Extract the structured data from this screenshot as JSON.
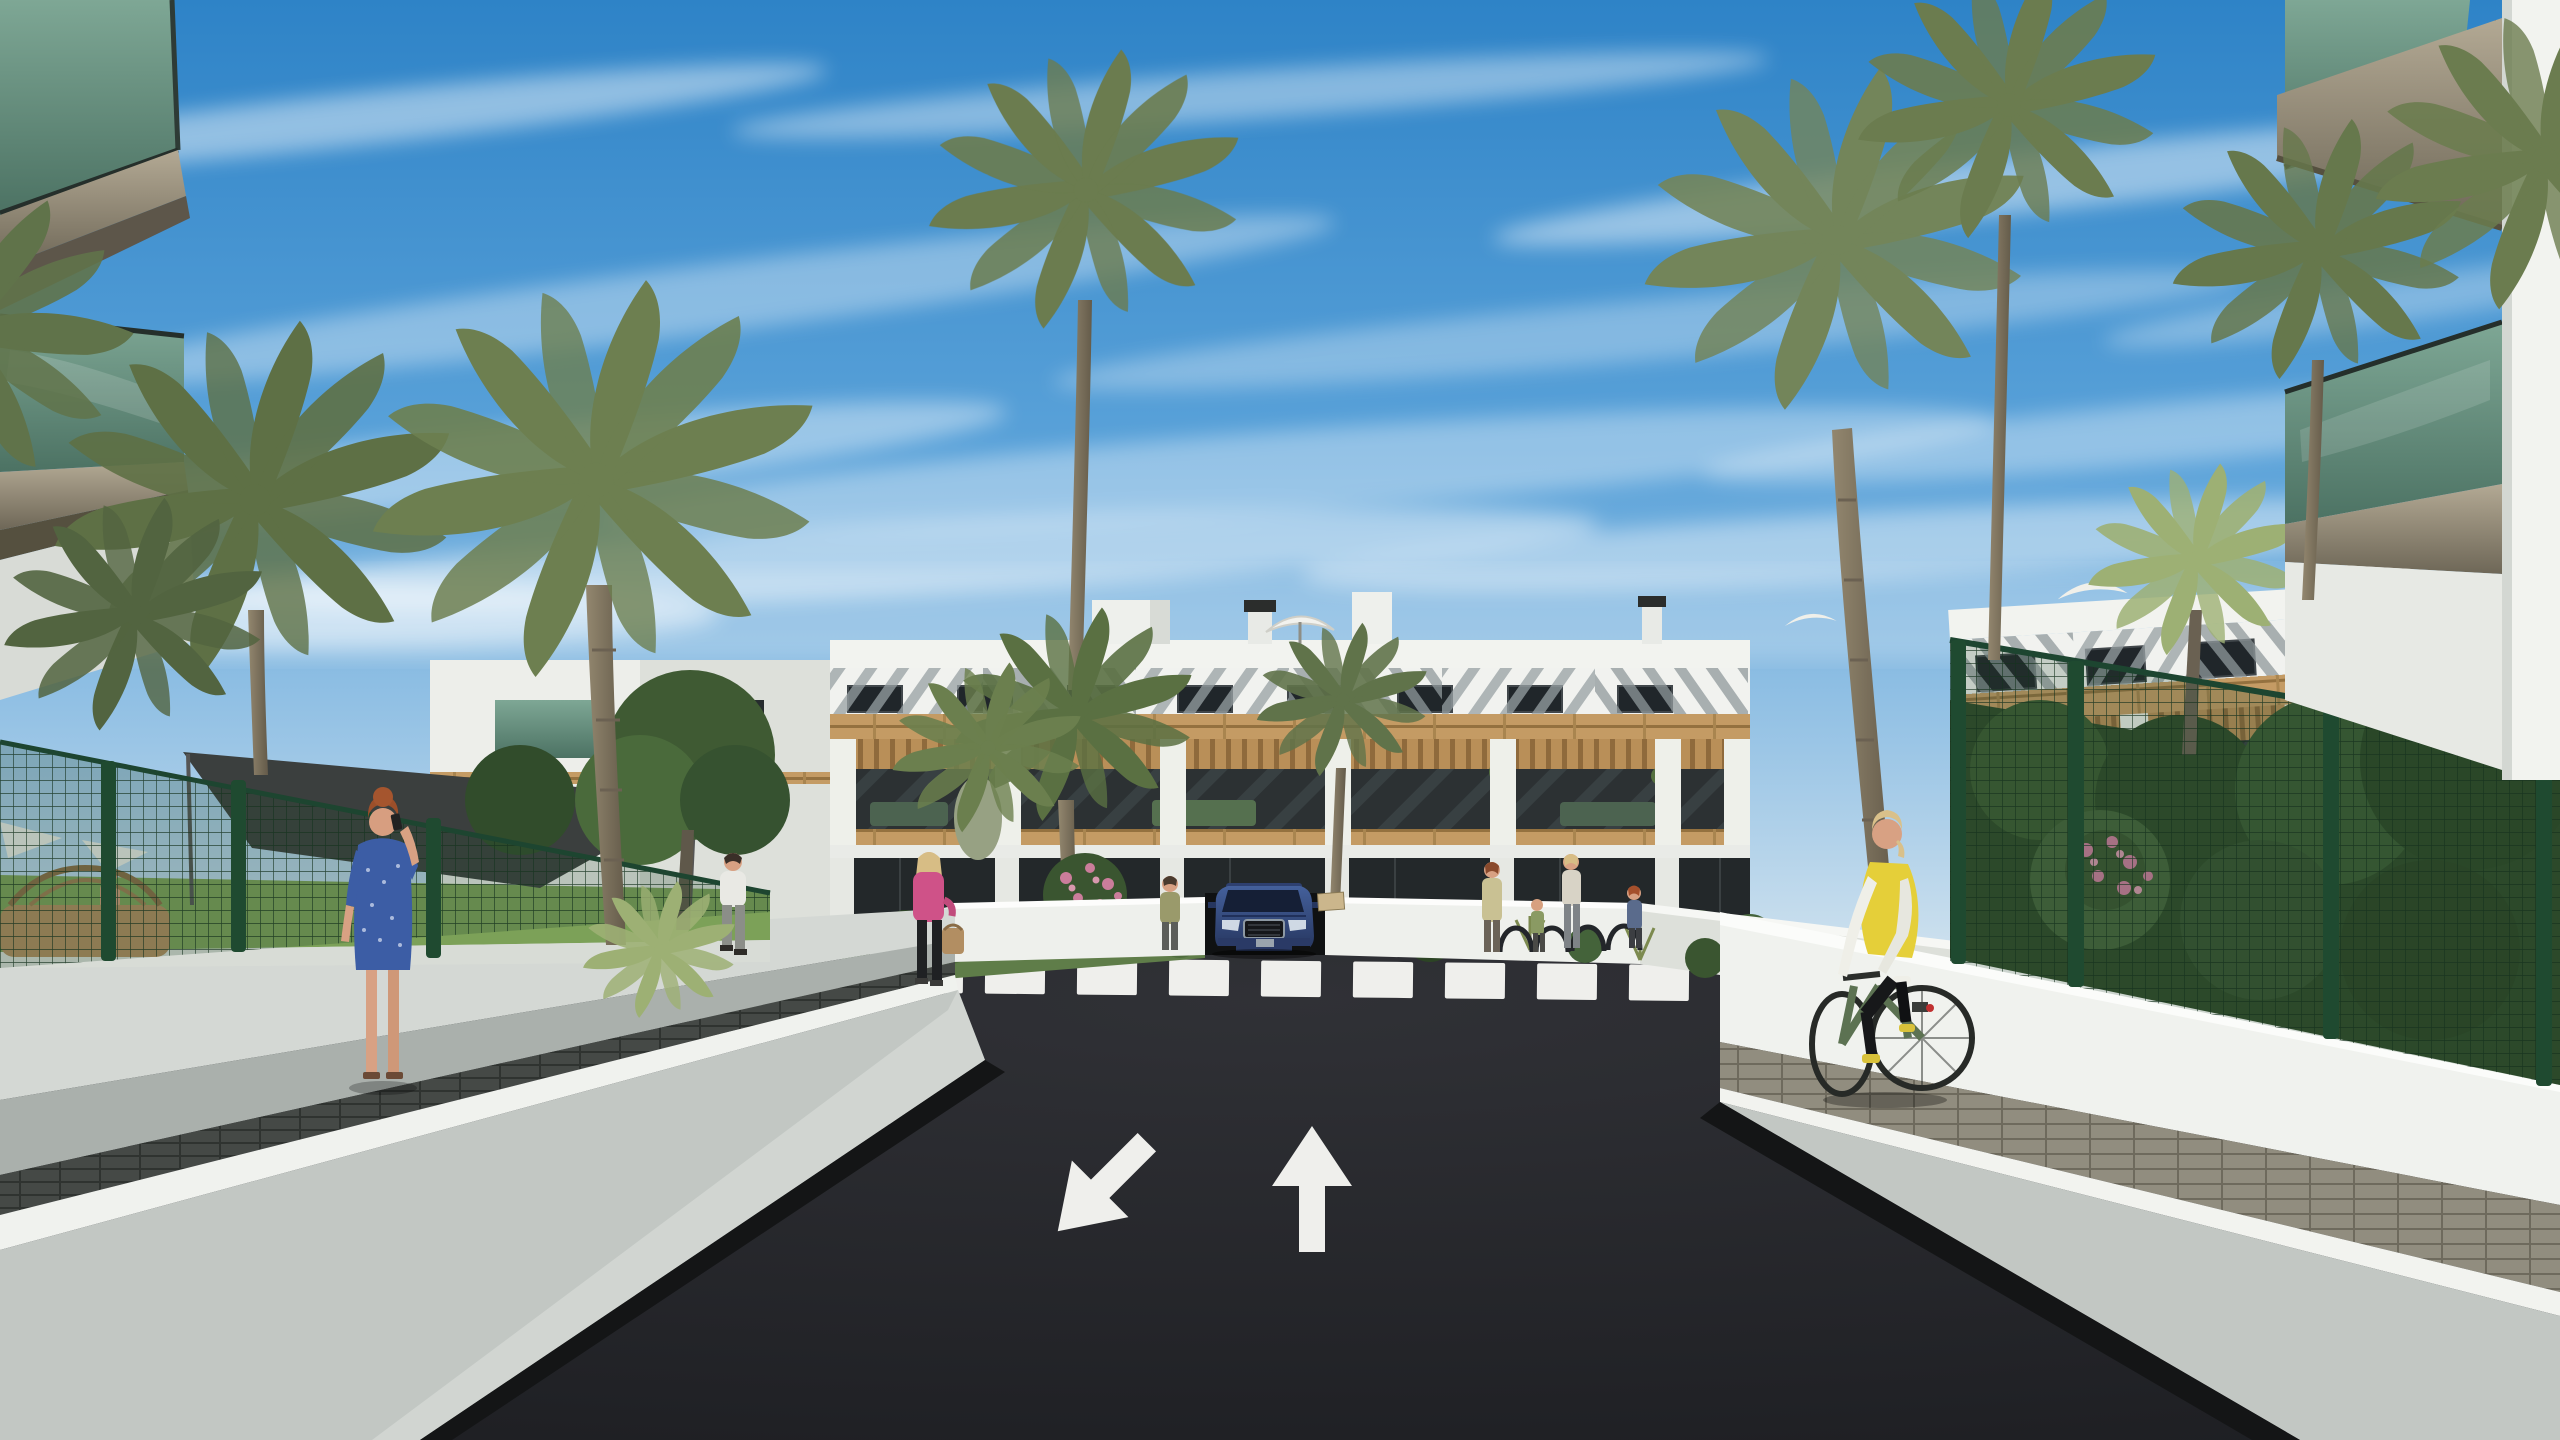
{
  "image": {
    "kind": "architectural-render",
    "setting": "residential apartment complex street view",
    "width": 2560,
    "height": 1440
  },
  "scene": {
    "colors": {
      "sky_top": "#2e83c7",
      "sky_mid": "#5aa2d9",
      "sky_low": "#9cc6e6",
      "sky_horizon": "#d9e7f0",
      "cloud": "#ffffff",
      "facade_white": "#f2f3ef",
      "facade_shade": "#d9dcd7",
      "louver_slat": "#97a0a3",
      "window_dark": "#20262a",
      "wood": "#c49b64",
      "pergola": "#b98f58",
      "terrace_glass": "#2c3133",
      "ground_glass": "#23282a",
      "balcony_glass_top": "#7ea795",
      "balcony_glass_bottom": "#4c7263",
      "fascia": "#9b9179",
      "fascia_dark": "#6e6757",
      "fence_green": "#1e4930",
      "asphalt": "#232428",
      "road_mark": "#efefec",
      "walk_concrete": "#aab0ac",
      "paver_dark": "#454946",
      "paver_tan": "#918d7f",
      "wall_white": "#f0f2ee",
      "wall_face": "#c2c7c3",
      "wall_base": "#141516",
      "grass": "#7ca158",
      "bush_dark": "#2c4425",
      "bush_mid": "#44633a",
      "palm_green": "#6f8153",
      "fan_palm": "#9db074",
      "trunk": "#8a7f68",
      "flower_pink": "#cb7d9b",
      "flower_orange": "#c97f3f",
      "car_body_top": "#44609b",
      "car_body_bottom": "#26365f",
      "headlight": "#cfd9e4",
      "skin": "#d8a183",
      "hair_red": "#9c4f2a",
      "hair_blonde": "#d7bd85",
      "dress_blue": "#3c5da5",
      "vest_yellow": "#e5cf39",
      "jacket_pink": "#cf5288",
      "shirt_white": "#e9e9e4",
      "sail_gray": "#3b3f3e",
      "umbrella_white": "#f2f2ee",
      "wicker": "#b08d5f",
      "sign_tan": "#cbb68c",
      "bike_green": "#5c7252"
    },
    "road": {
      "crosswalk_stripe_count": 12,
      "arrow_left_direction": "toward-viewer (down-left)",
      "arrow_right_direction": "away-from-viewer (up)"
    },
    "objects": [
      "three-story white apartment blocks with diagonal louvered top floor",
      "wood-clad terrace band with pergolas and outdoor furniture",
      "underground garage ramp with dark blue SUV emerging",
      "zebra crosswalk across asphalt street",
      "two painted lane arrows",
      "green mesh security fences with posts",
      "dark shade sail over pool garden",
      "white roof umbrellas and chimneys",
      "palm trees and flowering gardens",
      "bike racks near entrance",
      "glass-balustrade balconies framing foreground"
    ],
    "people": [
      {
        "id": "woman-blue-dress",
        "desc": "red-haired woman in blue dress on phone, back to viewer, left walk"
      },
      {
        "id": "shirtless-man",
        "desc": "man inside pool garden behind left fence"
      },
      {
        "id": "man-white-tshirt",
        "desc": "man walking away on left garden path"
      },
      {
        "id": "woman-pink-jacket",
        "desc": "blonde woman in pink jacket with tan handbag crossing path"
      },
      {
        "id": "woman-olive",
        "desc": "woman standing left of the garage ramp"
      },
      {
        "id": "family-group",
        "desc": "adults and a child near the entrance bike racks"
      },
      {
        "id": "cyclist",
        "desc": "woman in yellow vest on green bicycle riding the right sidewalk"
      },
      {
        "id": "terrace-residents",
        "desc": "small figures on first-floor terraces"
      }
    ]
  }
}
